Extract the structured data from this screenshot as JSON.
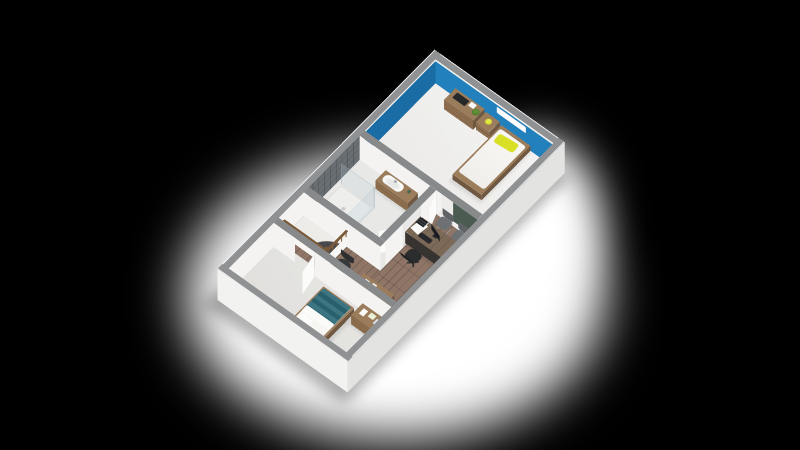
{
  "image": {
    "type": "3d-floorplan-render",
    "view": "isometric dollhouse (roof removed)",
    "background": "black letterbox with soft white ground plane under the model"
  },
  "scene": {
    "rotation_x_deg": 32,
    "rotation_z_deg": 40,
    "wall_height_units": 46
  },
  "colors": {
    "ground_white": "#ffffff",
    "cap_gray": "#8f9193",
    "cap_gray_dark": "#87898b",
    "ext_wall_sw": "#f2f2f0",
    "ext_wall_se": "#e3e3e1",
    "int_white": "#f4f3f1",
    "wall_blue": "#1a6ca5",
    "wall_blue_light": "#2280bd",
    "tile_gray": "#696e72",
    "green_board": "#4c5b52",
    "floor_white": "#edece9",
    "floor_bath": "#e8e8e6",
    "wood_floor": "#8e7566",
    "wood_floor_dark": "#836a5b",
    "furn_wood": "#8d6f4f",
    "furn_wood_top": "#9b7c5b",
    "furn_wood_dark": "#6f5740",
    "desk_top": "#7c6957",
    "desk_dark": "#363330",
    "teal_blanket": "#2e6b79",
    "yellow_accent": "#d8df25",
    "tread_dark": "#434347",
    "chair_gray": "#6e7174",
    "chair_dark": "#2b2c2e",
    "rail_wood": "#7b5a39",
    "door_white": "#fbfbfa"
  },
  "floorplan": {
    "rooms": [
      {
        "id": "bedroom-1",
        "type": "bedroom",
        "wall_finish": "blue paint with white baseboard",
        "floor": "light",
        "furniture": [
          "single bed with white duvet and yellow pillow",
          "nightstand with yellow ball lamp",
          "dresser with tv, white box and green plant",
          "white wall-mounted ac/shelf unit"
        ]
      },
      {
        "id": "bathroom",
        "type": "bathroom",
        "wall_finish": "dark gray tile and white",
        "floor": "light",
        "furniture": [
          "walk-in glass shower with tray",
          "wood vanity with white sink and faucet"
        ]
      },
      {
        "id": "office-landing",
        "type": "office / landing",
        "wall_finish": "white with dark green accent panel",
        "floor": "wood planks",
        "furniture": [
          "desk with monitor, keyboard, papers and letter tray",
          "black office chair",
          "two gray visitor chairs",
          "wood sideboard with decor",
          "dark tub chair"
        ]
      },
      {
        "id": "staircase",
        "type": "staircase",
        "features": [
          "white knee walls",
          "wood baluster railing in L shape",
          "curved dark winder treads"
        ]
      },
      {
        "id": "bedroom-2",
        "type": "bedroom",
        "wall_finish": "white",
        "floor": "light",
        "furniture": [
          "double bed with teal blanket and two white pillows",
          "chest of drawers with decor"
        ]
      }
    ],
    "doors": [
      "bedroom-1 white door (ajar)",
      "bathroom white door (ajar)",
      "bedroom-2 white door (ajar)"
    ]
  }
}
